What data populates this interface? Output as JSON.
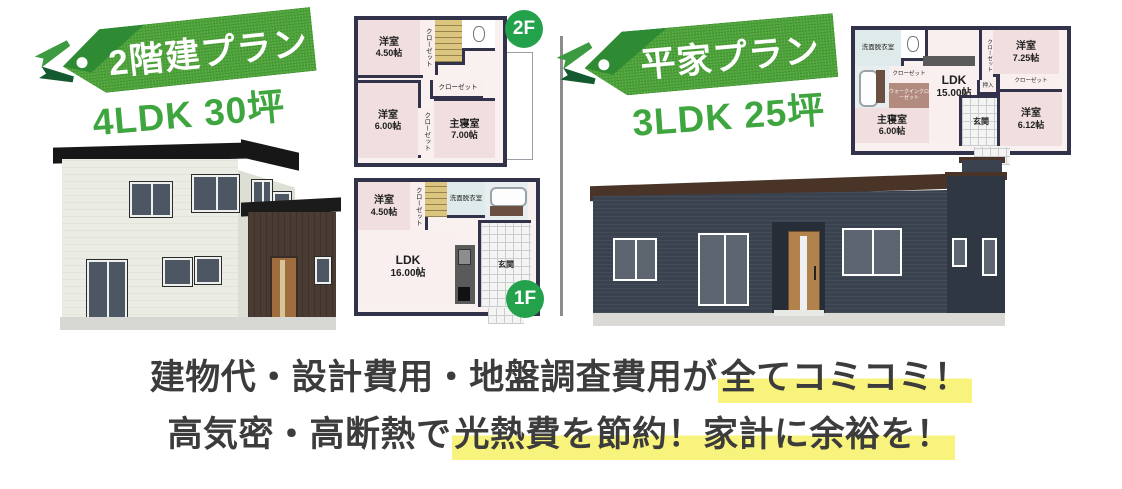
{
  "left_section": {
    "tag_label": "2階建プラン",
    "subtitle": "4LDK 30坪",
    "floor2": {
      "badge": "2F",
      "yoshitsu1": "洋室",
      "yoshitsu1_size": "4.50帖",
      "closet1": "クローゼット",
      "yoshitsu2": "洋室",
      "yoshitsu2_size": "6.00帖",
      "closet2": "クローゼット",
      "shushinshitsu": "主寝室",
      "shushinshitsu_size": "7.00帖",
      "closet3": "クローゼット"
    },
    "floor1": {
      "badge": "1F",
      "yoshitsu": "洋室",
      "yoshitsu_size": "4.50帖",
      "closet": "クローゼット",
      "senmen": "洗面脱衣室",
      "ldk": "LDK",
      "ldk_size": "16.00帖",
      "genkan": "玄関"
    }
  },
  "right_section": {
    "tag_label": "平家プラン",
    "subtitle": "3LDK 25坪",
    "plan": {
      "senmen": "洗面脱衣室",
      "closet1": "クローゼット",
      "closet2": "ウォークインクローゼット",
      "shushinshitsu": "主寝室",
      "shushinshitsu_size": "6.00帖",
      "ldk": "LDK",
      "ldk_size": "15.00帖",
      "closet3": "クローゼット",
      "oshiire": "押入",
      "yoshitsu1": "洋室",
      "yoshitsu1_size": "7.25帖",
      "closet4": "クローゼット",
      "genkan": "玄関",
      "yoshitsu2": "洋室",
      "yoshitsu2_size": "6.12帖"
    }
  },
  "footer": {
    "line1_normal": "建物代・設計費用・地盤調査費用が",
    "line1_highlight": "全てコミコミ！",
    "line2_normal": "高気密・高断熱で",
    "line2_highlight": "光熱費を節約！家計に余裕を！"
  },
  "colors": {
    "tag_green": "#4ca338",
    "tag_fold_green": "#2f8b33",
    "badge_green": "#23a14b",
    "subtitle_green": "#3fa53f",
    "highlight_yellow": "#f8f37c",
    "footer_text": "#3c3c3c",
    "plan_wall": "#32324a",
    "house_left_body": "#ebede4",
    "house_right_body": "#39424e"
  }
}
